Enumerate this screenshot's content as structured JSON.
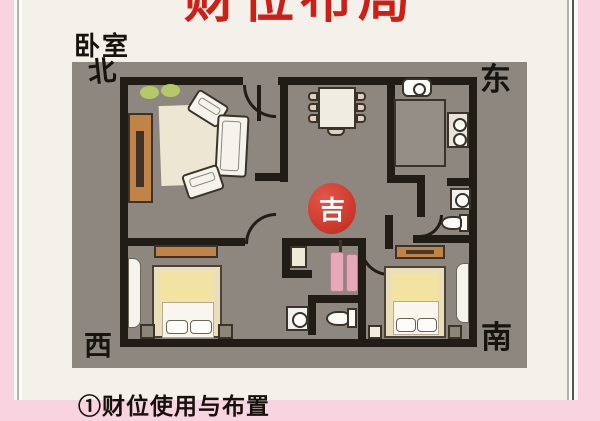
{
  "page": {
    "title": "财位布局",
    "room_label": "卧室",
    "caption": "①财位使用与布置"
  },
  "directions": {
    "north": "北",
    "east": "东",
    "west": "西",
    "south": "南"
  },
  "badge": {
    "label": "吉"
  },
  "colors": {
    "title_red": "#cc2017",
    "badge_red": "#cf3a2e",
    "frame_pink": "#f8d3e0",
    "panel_gray": "#8d8780",
    "wall": "#211c16",
    "wood_brown": "#c08348",
    "bed_yellow": "#f2e3a2",
    "plant_green": "#b5ca67",
    "towel_pink": "#e7a9b8"
  },
  "icons": {
    "sofa": "rounded-rect",
    "armchair": "rounded-rect",
    "rug": "rect",
    "tv-cabinet": "rect",
    "plant": "ellipse",
    "dining-table": "rect",
    "dining-chair": "rounded-rect",
    "kitchen-sink": "rounded-rect",
    "kitchen-counter": "rect",
    "stove": "rect-with-burners",
    "washing-machine": "square-with-circle",
    "toilet": "tank-and-bowl",
    "bed": "rect-with-pillows",
    "nightstand": "square",
    "wardrobe": "tall-rect",
    "shelf": "rect",
    "towel-rack": "pole-with-towels",
    "door": "quarter-arc"
  }
}
